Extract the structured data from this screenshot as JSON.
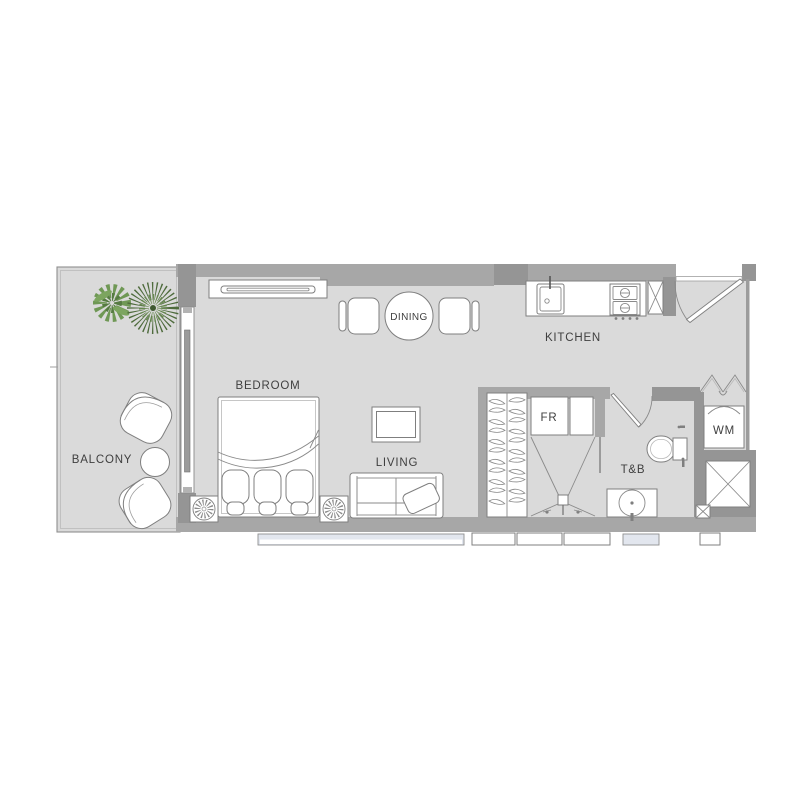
{
  "canvas": {
    "width": 800,
    "height": 800,
    "background": "#ffffff"
  },
  "rooms": {
    "balcony": {
      "label": "BALCONY"
    },
    "bedroom": {
      "label": "BEDROOM"
    },
    "dining": {
      "label": "DINING"
    },
    "kitchen": {
      "label": "KITCHEN"
    },
    "living": {
      "label": "LIVING"
    },
    "fridge": {
      "label": "FR"
    },
    "toilet_bath": {
      "label": "T&B"
    },
    "washing_machine": {
      "label": "WM"
    }
  },
  "colors": {
    "wall": "#a7a7a7",
    "wall_dark": "#959595",
    "floor": "#dadada",
    "furniture_fill": "#ffffff",
    "furniture_outline": "#7f7f7f",
    "window_band": "#e2e6ee",
    "plant_green_dark": "#4e6b3c",
    "plant_green_light": "#6f9855",
    "label_text": "#3f3f3f"
  },
  "icons": {
    "entry_door": "quarter-arc-swing",
    "bathroom_door": "quarter-arc-swing",
    "bifold_door": "double-chevron",
    "sliding_door": "rail-with-panel",
    "service_shaft": "x-crossed-box",
    "ceiling_lamp": "radial-spoke-circle",
    "plant": "leaf-burst",
    "coat_hanger": "lens-curve",
    "shower_drain": "small-square",
    "stove": "two-burner-grid",
    "sink": "basin-with-faucet"
  }
}
